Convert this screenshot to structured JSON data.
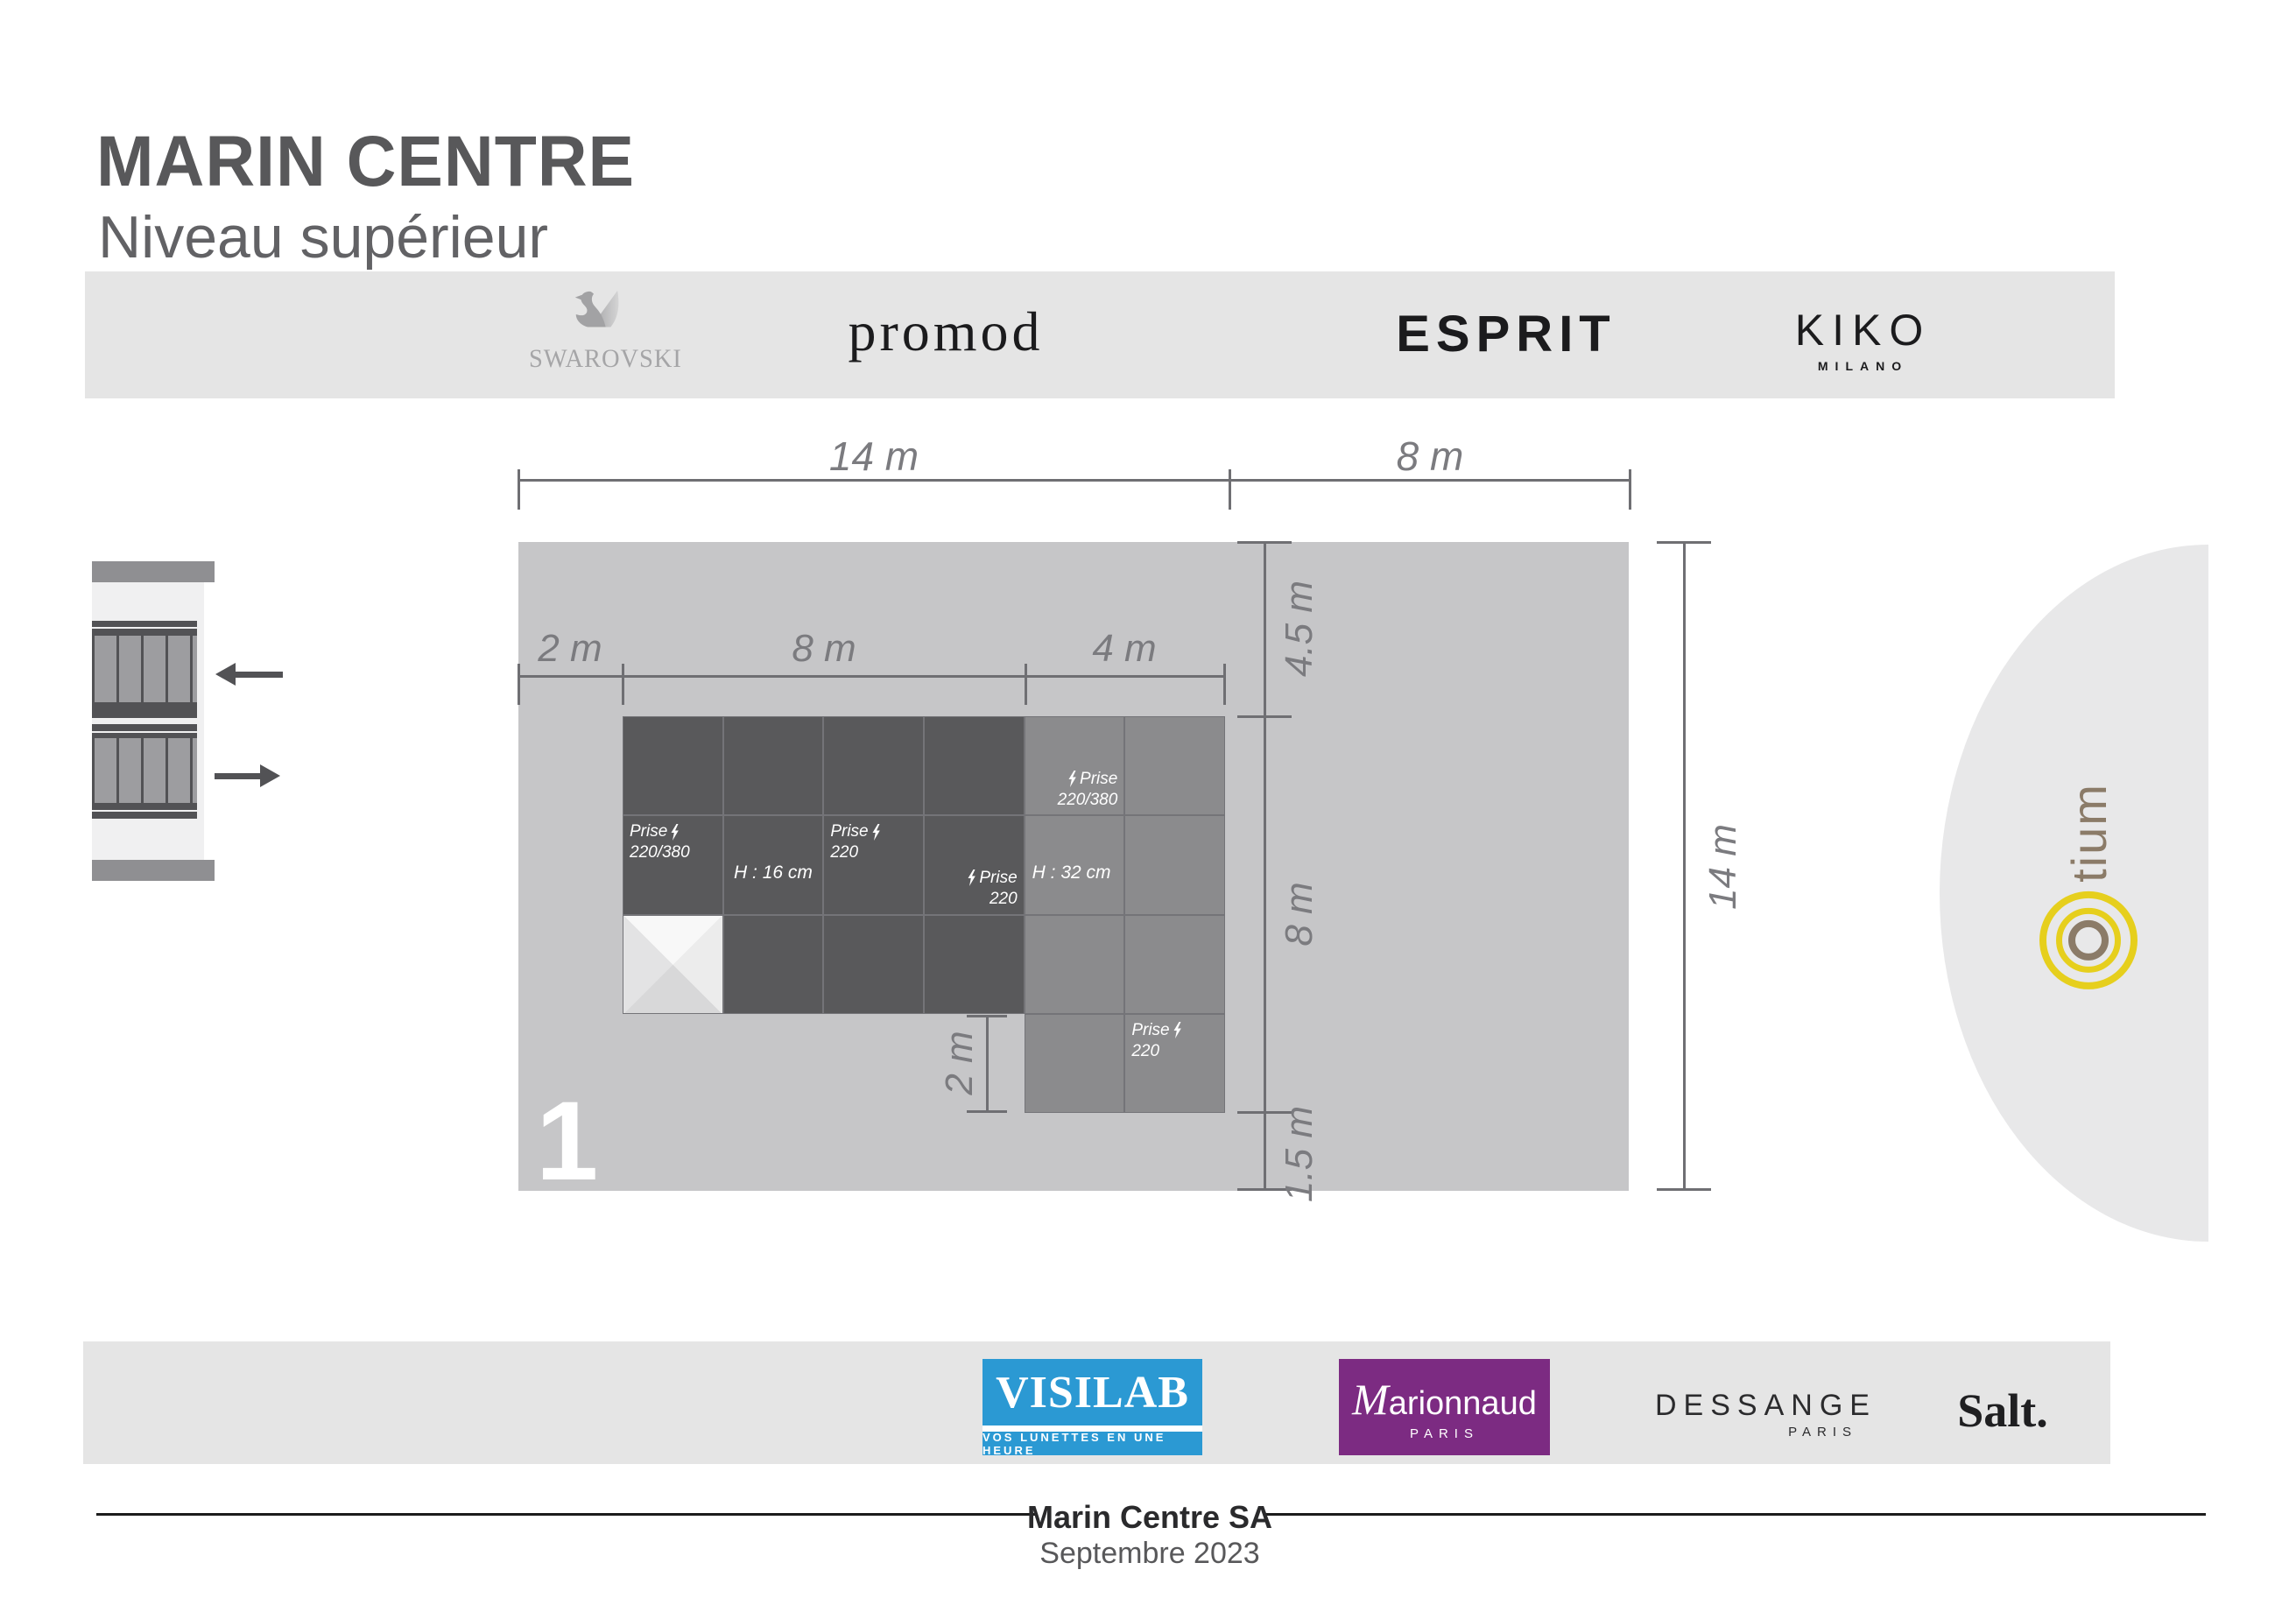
{
  "header": {
    "title": "MARIN CENTRE",
    "subtitle": "Niveau supérieur"
  },
  "top_banner": {
    "brands": [
      {
        "name": "swarovski",
        "wordmark": "SWAROVSKI"
      },
      {
        "name": "promod",
        "wordmark": "promod"
      },
      {
        "name": "esprit",
        "wordmark": "ESPRIT"
      },
      {
        "name": "kiko",
        "wordmark": "KIKO",
        "sub": "MILANO"
      }
    ]
  },
  "plan": {
    "unit_number": "1",
    "dimensions": {
      "top": [
        "14 m",
        "8 m"
      ],
      "inner": [
        "2 m",
        "8 m",
        "4 m"
      ],
      "right": [
        "4.5 m",
        "8 m",
        "1.5 m"
      ],
      "far_right": "14 m",
      "sub": "2 m"
    },
    "cells": {
      "c1r2": {
        "l1": "Prise",
        "l2": "220/380"
      },
      "c2r2": {
        "text": "H : 16 cm"
      },
      "c3r2": {
        "l1": "Prise",
        "l2": "220"
      },
      "c4r2": {
        "l1": "Prise",
        "l2": "220"
      },
      "c5r1": {
        "l1": "Prise",
        "l2": "220/380"
      },
      "c5r2": {
        "text": "H : 32 cm"
      },
      "c6r4": {
        "l1": "Prise",
        "l2": "220"
      }
    }
  },
  "otium": {
    "text": "tium"
  },
  "bottom_banner": {
    "brands": [
      {
        "name": "visilab",
        "wordmark": "VISILAB",
        "tagline": "VOS LUNETTES EN UNE HEURE"
      },
      {
        "name": "marionnaud",
        "initial": "M",
        "rest": "arionnaud",
        "sub": "PARIS"
      },
      {
        "name": "dessange",
        "wordmark": "DESSANGE",
        "sub": "PARIS"
      },
      {
        "name": "salt",
        "wordmark": "Salt."
      }
    ]
  },
  "footer": {
    "company": "Marin Centre SA",
    "date": "Septembre 2023"
  },
  "icons": {
    "swan": "swan-icon",
    "lightning": "lightning-bolt-icon",
    "escalator": "escalator-icon",
    "arrow_up_level": "arrow-left-icon",
    "arrow_down_level": "arrow-right-icon",
    "otium_rings": "concentric-rings-icon"
  },
  "colors": {
    "plan_background": "#c6c6c8",
    "module_dark": "#59595b",
    "module_light": "#8b8b8d",
    "banner_background": "#e5e5e5",
    "dimension_gray": "#6f6f73",
    "visilab_blue": "#2b99d3",
    "marionnaud_purple": "#7c2b82",
    "otium_yellow": "#e6cf1d",
    "otium_brown": "#8b7b68"
  }
}
